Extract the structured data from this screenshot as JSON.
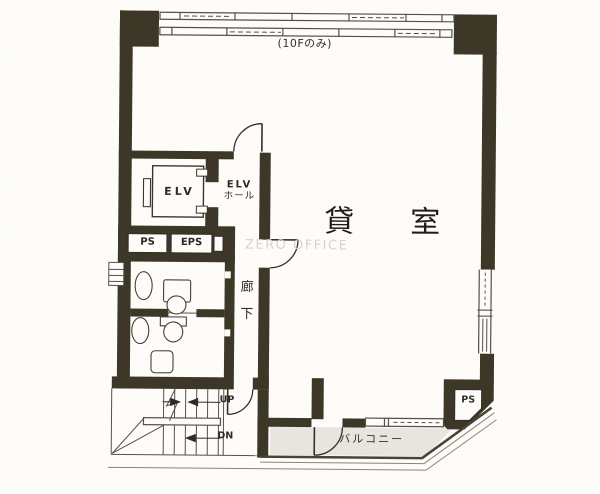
{
  "plan": {
    "top_note": "(10Fのみ)",
    "elevator_label": "ELV",
    "elevator_hall": {
      "line1": "ELV",
      "line2": "ホール"
    },
    "shaft_left": "PS",
    "shaft_right": "EPS",
    "main_room": "貸室",
    "corridor": "廊下",
    "stairs": {
      "up": "UP",
      "down": "DN"
    },
    "balcony": "バルコニー",
    "shaft_bottom": "PS",
    "watermark": "ZERO OFFICE"
  },
  "colors": {
    "wall": "#3d3728",
    "line": "#4f4a3e",
    "thin": "#55504a",
    "balcony_floor": "#e7e5df",
    "paper": "#fdfcf9",
    "watermark": "#d7d4cb",
    "ink": "#222222"
  }
}
